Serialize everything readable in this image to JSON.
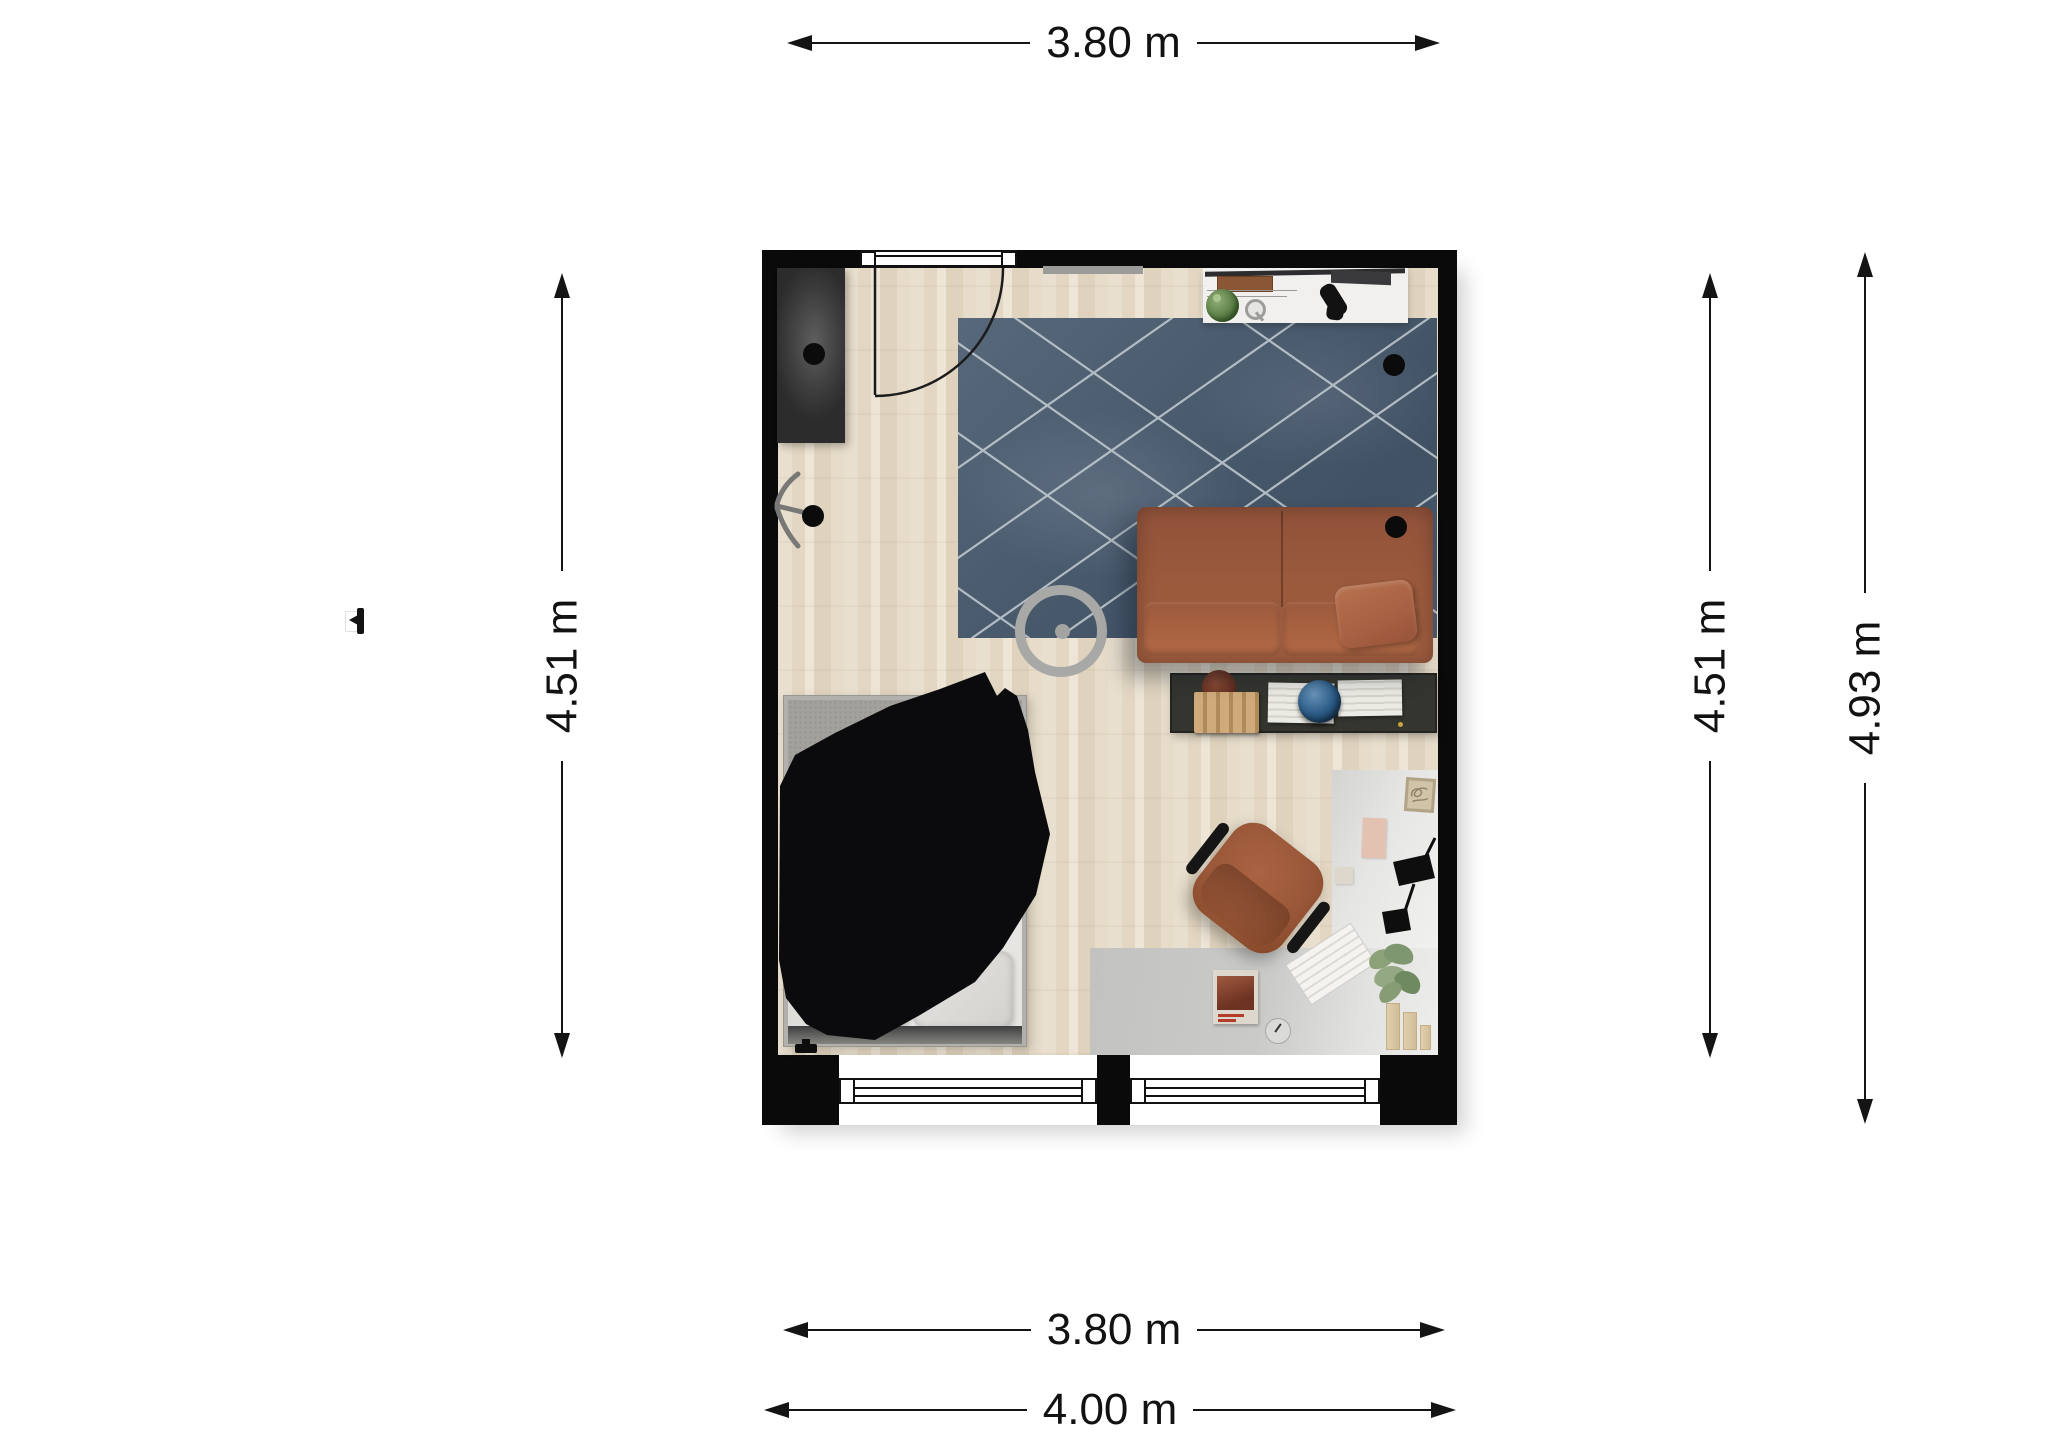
{
  "page": {
    "background": "#ffffff",
    "type": "2d-floor-plan-render"
  },
  "floor_plan": {
    "dimensions": {
      "top_width": "3.80 m",
      "left_height": "4.51 m",
      "right_inner_height": "4.51 m",
      "right_outer_height": "4.93 m",
      "bottom_inner_width": "3.80 m",
      "bottom_outer_width": "4.00 m"
    },
    "colors": {
      "wall": "#0a0a0a",
      "floor_wood": "#e6dbc8",
      "rug": "#4a5b6e",
      "rug_lines": "#ccd4d9",
      "sofa": "#9a593c",
      "media_console": "#35352f",
      "bed_frame": "#b2b0ac",
      "duvet": "#e9e8e5",
      "blanket": "#0b0b0d",
      "desk_rug": "#c9c9c7",
      "chair": "#9c5a3b",
      "globe": "#2e5f8a",
      "plant": "#5f8249",
      "accent_wood": "#cfab7c"
    },
    "rooms": [
      {
        "name": "studio-living-room",
        "furniture": [
          "wardrobe",
          "ceiling-spotlights",
          "fan",
          "bed",
          "black-throw-blanket",
          "pillows",
          "diamond-rug",
          "ring-floor-lamp",
          "leather-sofa",
          "lumbar-cushion",
          "media-console",
          "file-organizer",
          "decor-bowl",
          "book-stacks",
          "globe",
          "sideboard",
          "tv",
          "plant",
          "magnifier",
          "game-controller",
          "desk-rug",
          "office-chair",
          "desk-lamp",
          "keyboard",
          "desk-plant",
          "magazine",
          "wall-art",
          "paper-trays",
          "door",
          "windows"
        ]
      }
    ]
  }
}
